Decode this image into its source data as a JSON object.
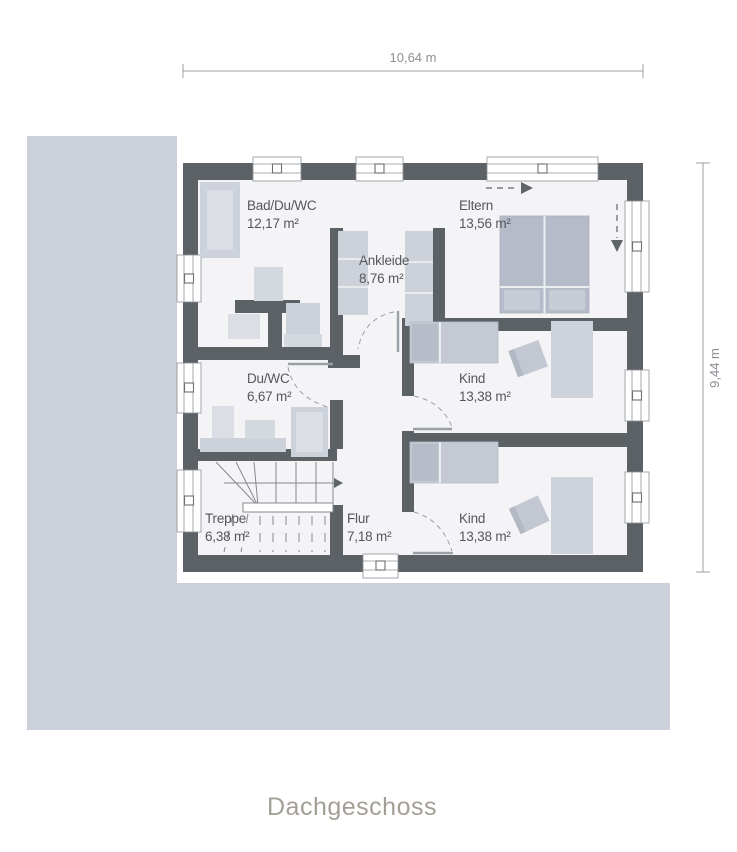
{
  "title": "Dachgeschoss",
  "dimensions": {
    "width": "10,64 m",
    "height": "9,44 m"
  },
  "rooms": {
    "bad": {
      "name": "Bad/Du/WC",
      "area": "12,17 m²"
    },
    "eltern": {
      "name": "Eltern",
      "area": "13,56 m²"
    },
    "ankleide": {
      "name": "Ankleide",
      "area": "8,76 m²"
    },
    "duwc": {
      "name": "Du/WC",
      "area": "6,67 m²"
    },
    "kind1": {
      "name": "Kind",
      "area": "13,38 m²"
    },
    "treppe": {
      "name": "Treppe",
      "area": "6,38 m²"
    },
    "flur": {
      "name": "Flur",
      "area": "7,18 m²"
    },
    "kind2": {
      "name": "Kind",
      "area": "13,38 m²"
    }
  },
  "colors": {
    "wall": "#5c6165",
    "floor": "#f4f4f6",
    "background_area": "#cbd0da",
    "furniture": "#ccd1da",
    "furniture_light": "#dbdee4",
    "bed": "#b5bbc8",
    "dimension_line": "#9aa0a4",
    "room_label": "#54575b",
    "title_text": "#a49f96"
  }
}
